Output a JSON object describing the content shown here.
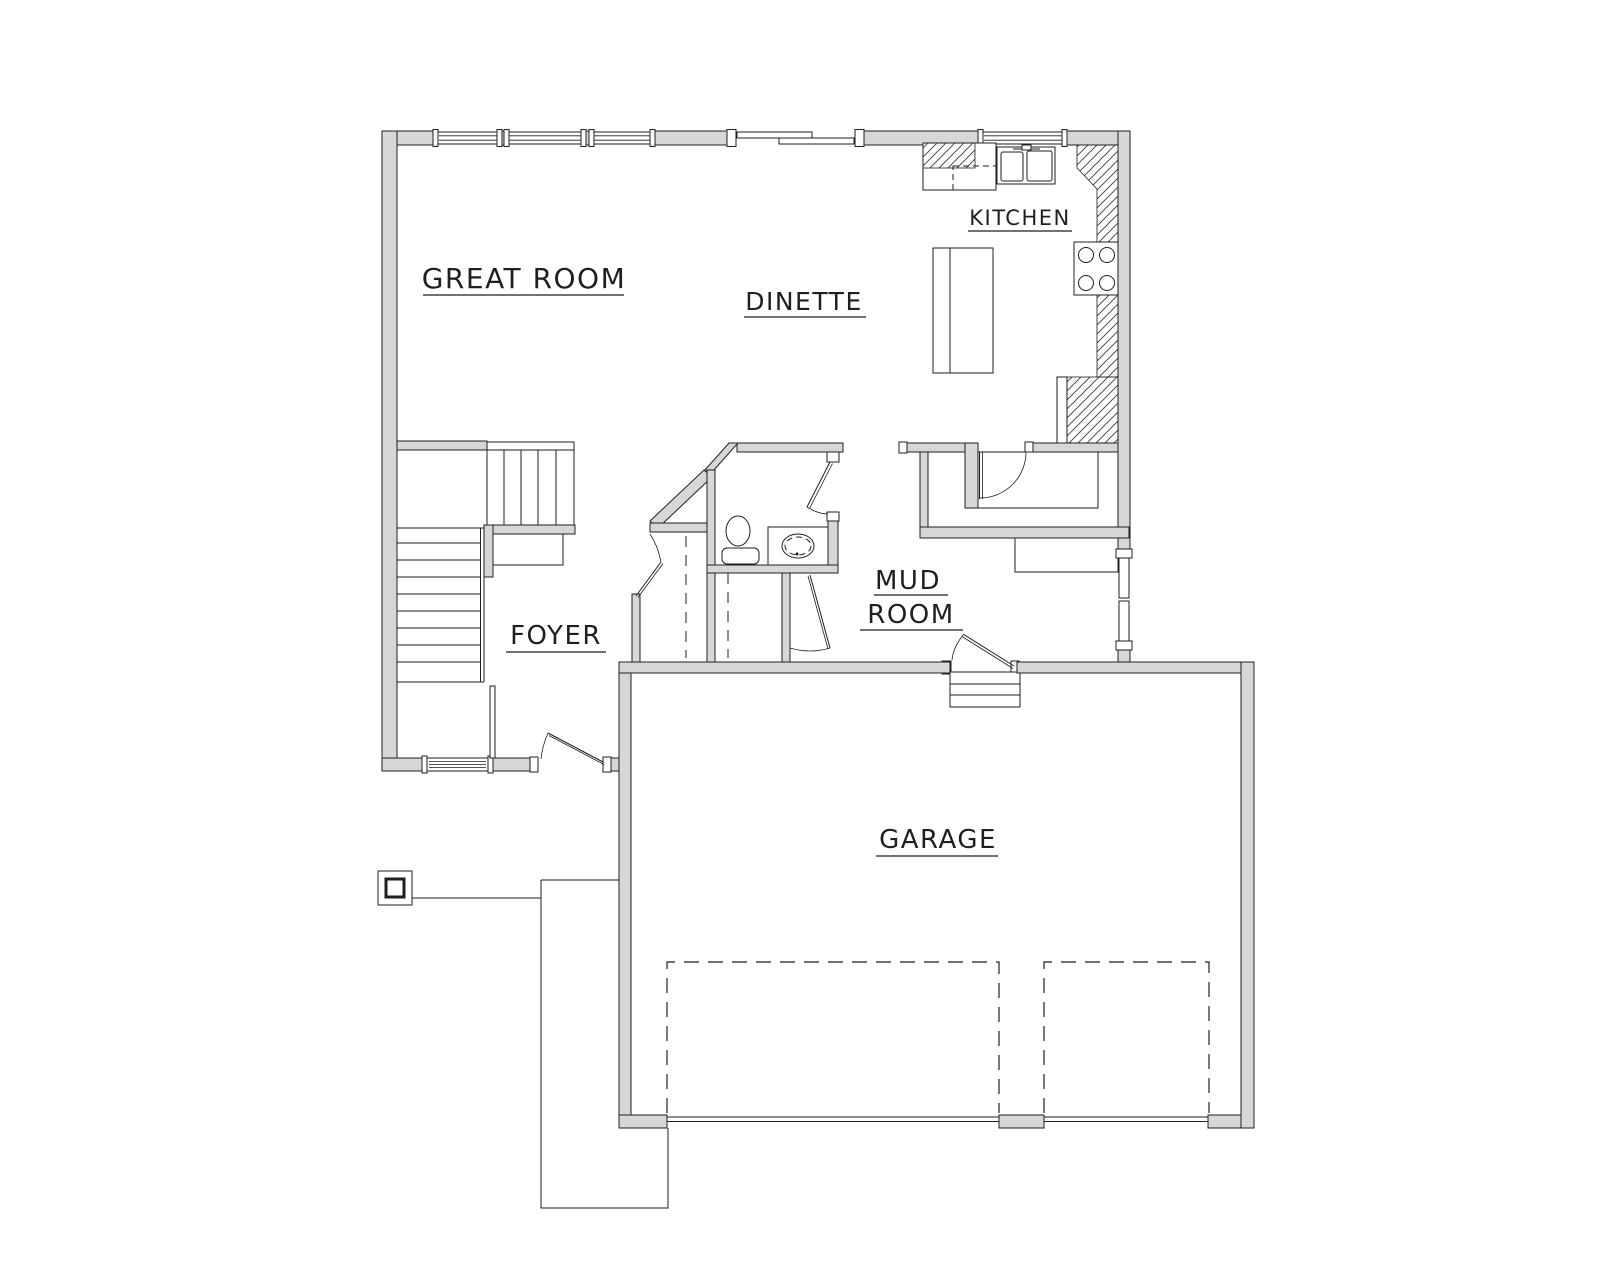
{
  "rooms": {
    "great_room": {
      "label": "GREAT ROOM"
    },
    "dinette": {
      "label": "DINETTE"
    },
    "kitchen": {
      "label": "KITCHEN"
    },
    "foyer": {
      "label": "FOYER"
    },
    "mud_room": {
      "label_line_1": "MUD",
      "label_line_2": "ROOM"
    },
    "garage": {
      "label": "GARAGE"
    }
  },
  "colors": {
    "background": "#ffffff",
    "wall_fill": "#d7d7d7",
    "line": "#1f1f1f",
    "hatch_line": "#3c3c3c",
    "text": "#1f1f1f"
  },
  "fixtures": {
    "kitchen": [
      "refrigerator-icon",
      "double-basin-sink-icon",
      "cooktop-4-burner-icon",
      "island-icon",
      "counter-hatch-icon",
      "pantry-cabinet-icon"
    ],
    "powder_room": [
      "toilet-icon",
      "vanity-sink-icon"
    ],
    "foyer": [
      "staircase-icon",
      "coat-closet-rod-icon"
    ],
    "mud_room": [
      "walk-in-closet-icon",
      "closet-rod-icon",
      "bench-icon",
      "garage-steps-icon"
    ],
    "garage": [
      "parking-stall-icon",
      "parking-stall-icon",
      "garage-door-sill-icon"
    ],
    "exterior": [
      "window-icon",
      "sliding-patio-door-icon",
      "front-door-icon",
      "back-door-icon",
      "porch-column-icon",
      "walkway-icon"
    ]
  }
}
